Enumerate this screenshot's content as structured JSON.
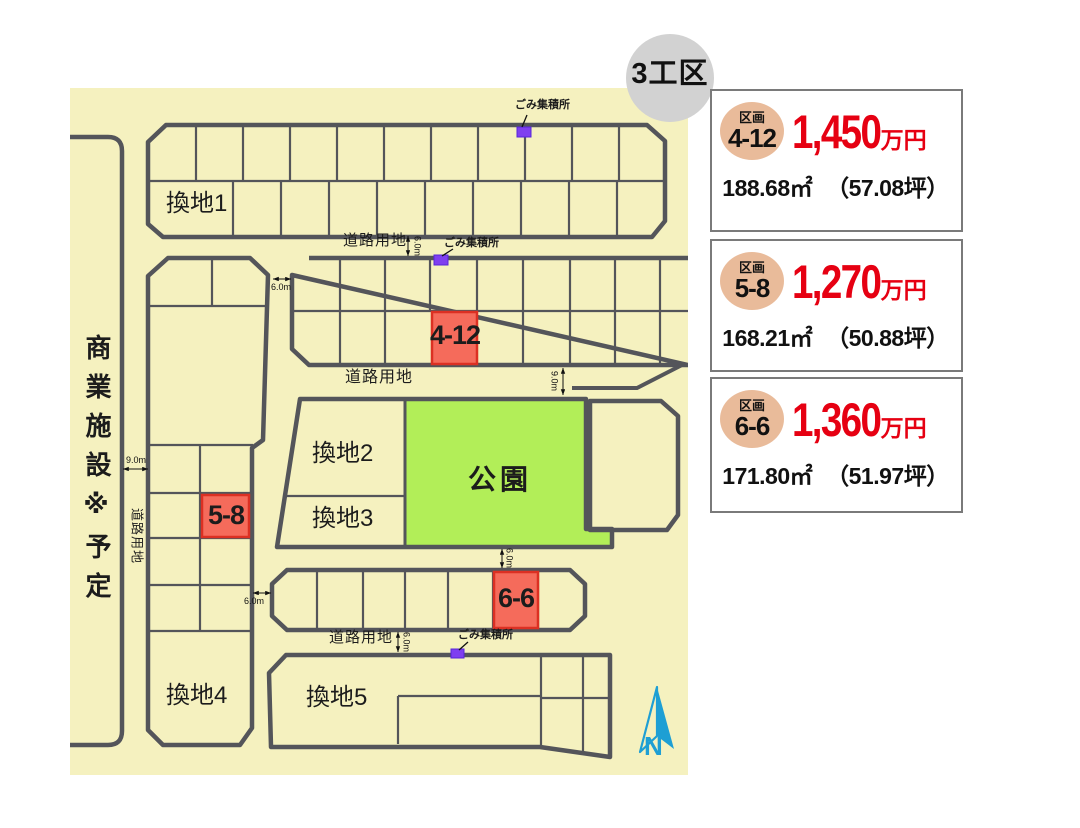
{
  "badge": {
    "label": "3工区"
  },
  "map": {
    "plots": {
      "kanchi1": "換地1",
      "kanchi2": "換地2",
      "kanchi3": "換地3",
      "kanchi4": "換地4",
      "kanchi5": "換地5",
      "park": "公園",
      "commercial_note": "商業施設※予定",
      "lot_4_12": "4-12",
      "lot_5_8": "5-8",
      "lot_6_6": "6-6"
    },
    "annotations": {
      "road_land": "道路用地",
      "garbage_station": "ごみ集積所",
      "dim_6m": "6.0m",
      "dim_9m": "9.0m",
      "north": "N"
    },
    "colors": {
      "map_background": "#f5f1bf",
      "boundary_line": "#54555a",
      "highlight_lot_fill": "#f56b5b",
      "highlight_lot_border": "#dc3023",
      "park_green": "#b2ee58",
      "garbage_marker_purple": "#7f3ff0",
      "compass_blue": "#1e9fd4",
      "price_red": "#e60012",
      "lot_circle_tan": "#e9bb9a",
      "badge_gray": "#d2d2d2"
    }
  },
  "cards": [
    {
      "tag": "区画",
      "lot": "4-12",
      "price": "1,450",
      "unit": "万円",
      "area_m2": "188.68㎡",
      "area_tsubo": "（57.08坪）"
    },
    {
      "tag": "区画",
      "lot": "5-8",
      "price": "1,270",
      "unit": "万円",
      "area_m2": "168.21㎡",
      "area_tsubo": "（50.88坪）"
    },
    {
      "tag": "区画",
      "lot": "6-6",
      "price": "1,360",
      "unit": "万円",
      "area_m2": "171.80㎡",
      "area_tsubo": "（51.97坪）"
    }
  ]
}
